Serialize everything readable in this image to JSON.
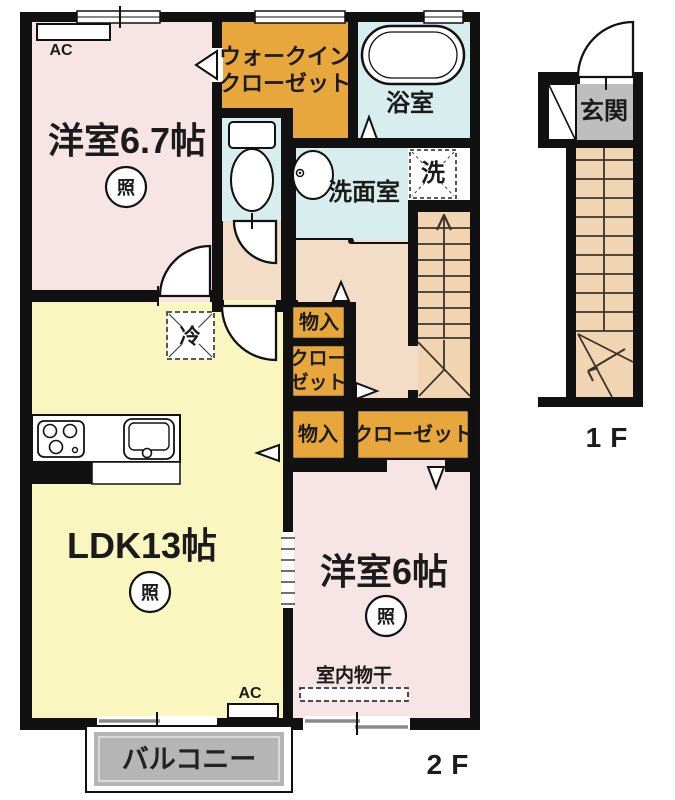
{
  "floor2": {
    "floor_label": "2F",
    "bedroom67": "洋室6.7帖",
    "bedroom6": "洋室6帖",
    "ldk": "LDK13帖",
    "wic_line1": "ウォークイン",
    "wic_line2": "クローゼット",
    "bath": "浴室",
    "washroom": "洗面室",
    "laundry": "洗",
    "fridge": "冷",
    "light": "照",
    "ac": "AC",
    "storage": "物入",
    "closet_line1": "クロー",
    "closet_line2": "ゼット",
    "closet": "クローゼット",
    "indoor_drying": "室内物干",
    "balcony": "バルコニー"
  },
  "floor1": {
    "floor_label": "1F",
    "entrance": "玄関"
  },
  "colors": {
    "wall": "#111111",
    "bedroom_pink": "#F7E4E4",
    "ldk_yellow": "#FAF6C0",
    "closet_orange": "#E8A73C",
    "wet_blue": "#D8EDEE",
    "hall_peach": "#F3DDC6",
    "stairs_tan": "#F1D4B2",
    "entrance_gray": "#BEBEBE",
    "balcony_gray": "#B5B5B5"
  }
}
